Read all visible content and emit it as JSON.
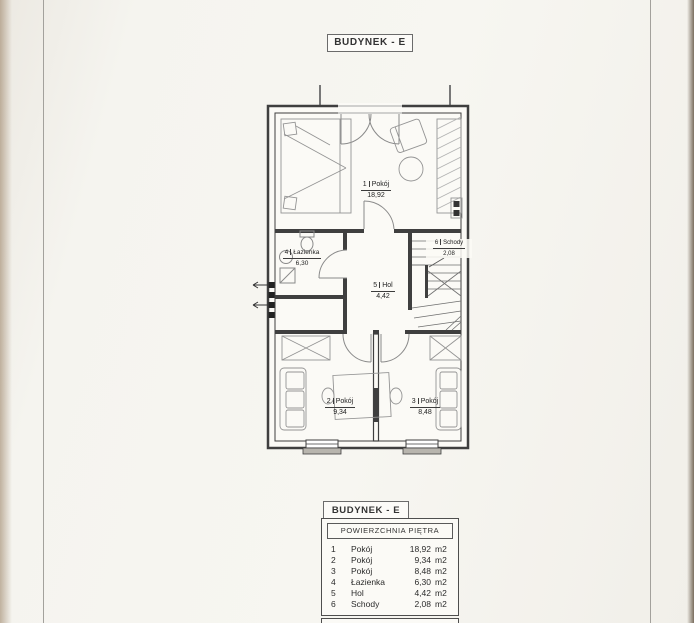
{
  "document": {
    "top_title": "BUDYNEK - E",
    "legend": {
      "box_title": "BUDYNEK - E",
      "header": "POWIERZCHNIA PIĘTRA",
      "rows": [
        {
          "num": "1",
          "name": "Pokój",
          "area": "18,92",
          "unit": "m2"
        },
        {
          "num": "2",
          "name": "Pokój",
          "area": "9,34",
          "unit": "m2"
        },
        {
          "num": "3",
          "name": "Pokój",
          "area": "8,48",
          "unit": "m2"
        },
        {
          "num": "4",
          "name": "Łazienka",
          "area": "6,30",
          "unit": "m2"
        },
        {
          "num": "5",
          "name": "Hol",
          "area": "4,42",
          "unit": "m2"
        },
        {
          "num": "6",
          "name": "Schody",
          "area": "2,08",
          "unit": "m2"
        }
      ]
    },
    "plan": {
      "labels": {
        "room1": {
          "num": "1",
          "name": "Pokój",
          "area": "18,92"
        },
        "room2": {
          "num": "2",
          "name": "Pokój",
          "area": "9,34"
        },
        "room3": {
          "num": "3",
          "name": "Pokój",
          "area": "8,48"
        },
        "bathroom": {
          "num": "4",
          "name": "Łazienka",
          "area": "6,30"
        },
        "hall": {
          "num": "5",
          "name": "Hol",
          "area": "4,42"
        },
        "stairs": {
          "num": "6",
          "name": "Schody",
          "area": "2,08"
        }
      }
    },
    "colors": {
      "paper": "#f6f5f0",
      "ink": "#3f3f3f",
      "furniture": "#909090"
    }
  }
}
